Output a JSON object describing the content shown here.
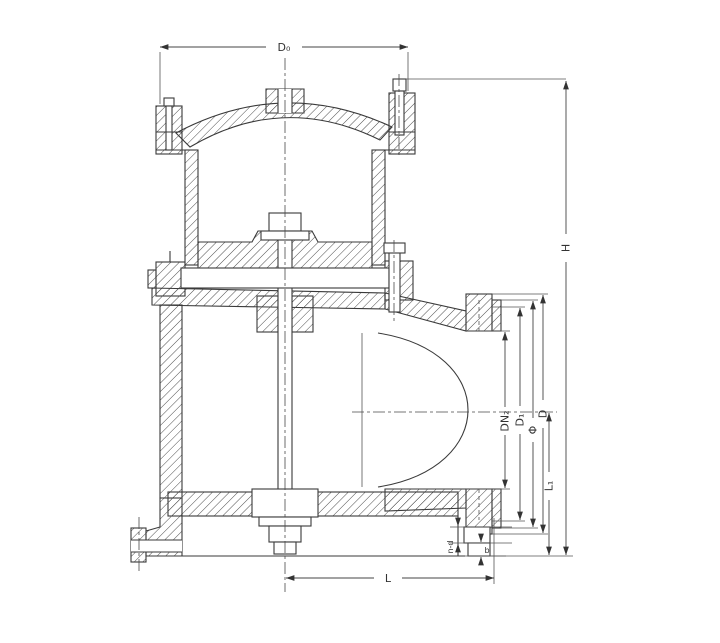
{
  "drawing": {
    "background": "#ffffff",
    "line_color": "#3a3a3a",
    "dim_color": "#444444",
    "labels": {
      "top_width": "D₀",
      "overall_height": "H",
      "outlet_center_height": "L₁",
      "flange_outer_diameter": "D",
      "raised_face_diameter": "Φ",
      "bolt_circle_diameter": "D₁",
      "nominal_diameter": "DN₂",
      "center_to_face_length": "L",
      "flange_thickness": "b",
      "bolt_holes": "n-d"
    }
  }
}
